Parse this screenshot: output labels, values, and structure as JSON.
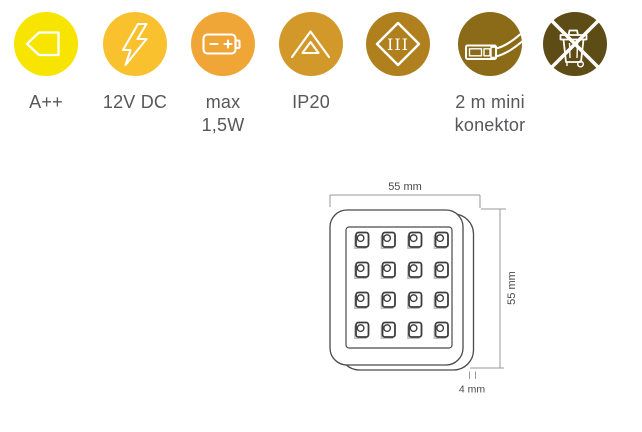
{
  "icons": [
    {
      "glyph": "energy-class-arrow-icon",
      "color": "#F7E400",
      "label_lines": [
        "A++"
      ]
    },
    {
      "glyph": "lightning-bolt-icon",
      "color": "#FAC12E",
      "label_lines": [
        "12V DC"
      ]
    },
    {
      "glyph": "battery-icon",
      "color": "#F0A636",
      "label_lines": [
        "max",
        "1,5W"
      ]
    },
    {
      "glyph": "double-triangle-icon",
      "color": "#D2982A",
      "label_lines": [
        "IP20"
      ]
    },
    {
      "glyph": "class-iii-diamond-icon",
      "color": "#B07F1E",
      "label_lines": [],
      "roman_numeral": "III"
    },
    {
      "glyph": "cable-connector-icon",
      "color": "#8B6B17",
      "label_lines": [
        "2 m mini",
        "konektor"
      ]
    },
    {
      "glyph": "crossed-out-trash-bin-icon",
      "color": "#5E4C16",
      "label_lines": []
    }
  ],
  "diagram": {
    "width_label": "55 mm",
    "height_label": "55 mm",
    "depth_label": "4 mm",
    "led_grid": {
      "rows": 4,
      "cols": 4
    }
  },
  "style": {
    "label_color": "#57575a",
    "dimension_text_color": "#4a4a4a",
    "panel_line_color": "#4a4a4a",
    "dim_line_color": "#9a9a9a"
  }
}
